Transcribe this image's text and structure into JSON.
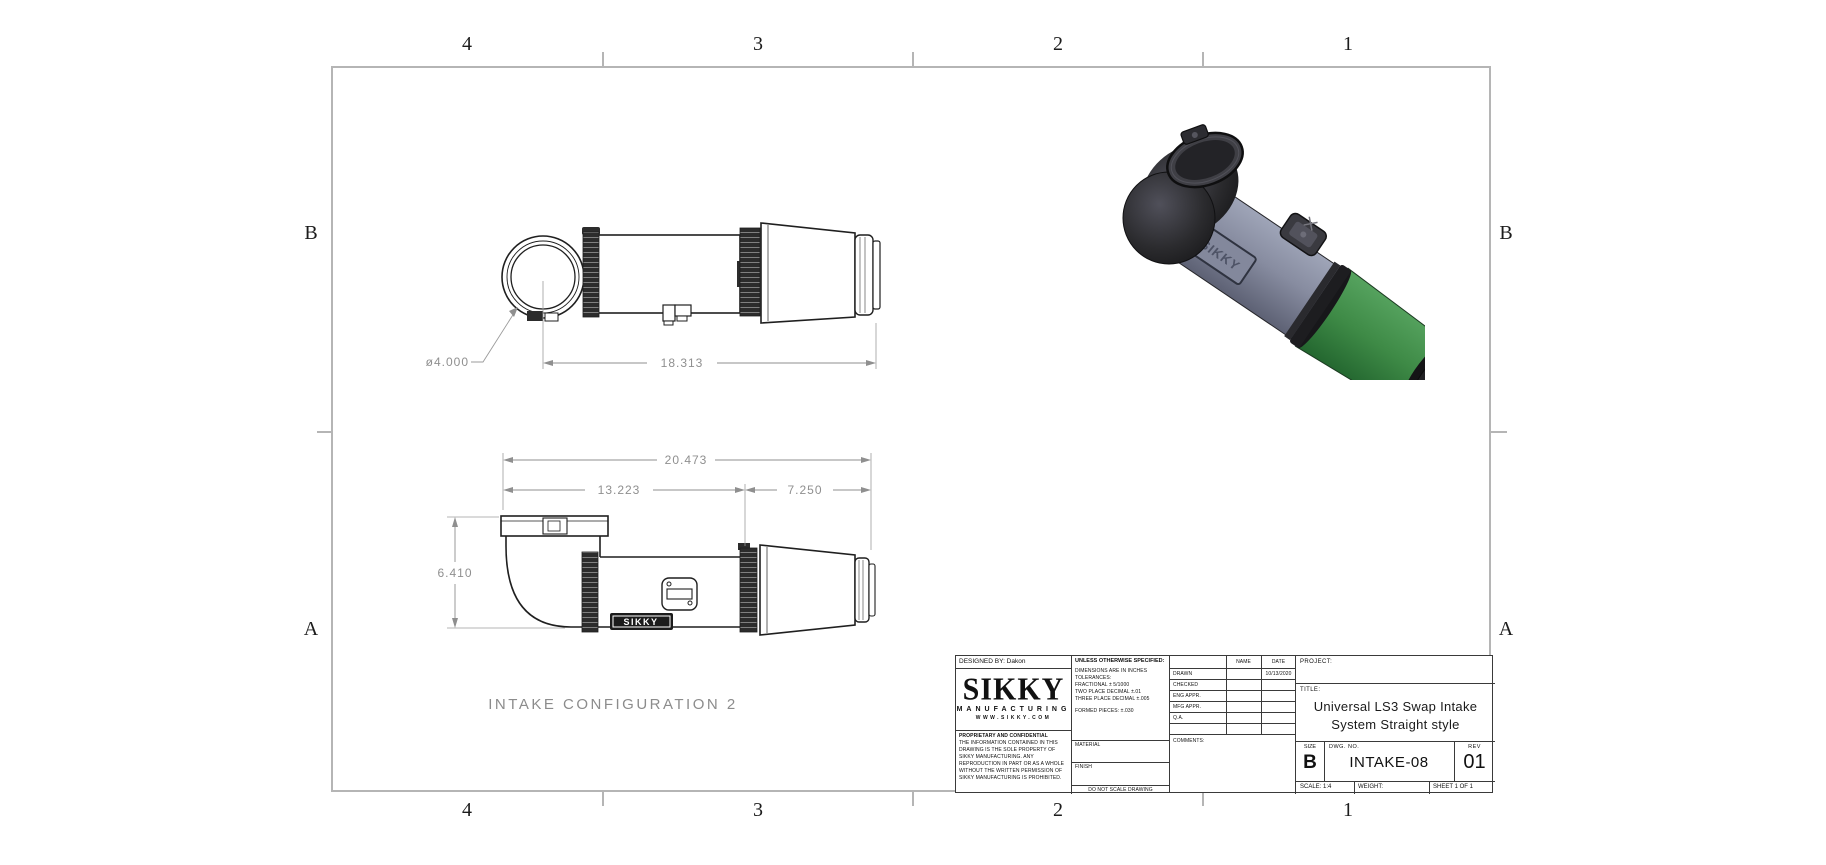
{
  "zones": {
    "top": [
      "4",
      "3",
      "2",
      "1"
    ],
    "bottom": [
      "4",
      "3",
      "2",
      "1"
    ],
    "left": [
      "B",
      "A"
    ],
    "right": [
      "B",
      "A"
    ]
  },
  "drawing": {
    "caption": "INTAKE CONFIGURATION 2",
    "badge": "SIKKY",
    "dims": {
      "diameter": "ø4.000",
      "overall_top": "18.313",
      "overall": "20.473",
      "tube": "13.223",
      "filter": "7.250",
      "height": "6.410"
    },
    "iso_colors": {
      "tube": "#878ca0",
      "filter": "#3e8a46",
      "elbow": "#2b2b2e",
      "cap": "#1a1a1d"
    }
  },
  "title_block": {
    "designed_by": "DESIGNED BY: Dakon",
    "logo": {
      "name": "SIKKY",
      "sub": "MANUFACTURING",
      "url": "WWW.SIKKY.COM"
    },
    "proprietary": {
      "heading": "PROPRIETARY AND CONFIDENTIAL",
      "body": "THE INFORMATION CONTAINED IN THIS DRAWING IS THE SOLE PROPERTY OF SIKKY MANUFACTURING.  ANY REPRODUCTION IN PART OR AS A WHOLE WITHOUT THE WRITTEN PERMISSION OF SIKKY MANUFACTURING IS PROHIBITED."
    },
    "spec": {
      "heading": "UNLESS OTHERWISE SPECIFIED:",
      "line1": "DIMENSIONS ARE IN INCHES",
      "line2": "TOLERANCES:",
      "line3": "FRACTIONAL ± 5/1000",
      "line4": "TWO PLACE DECIMAL    ±.01",
      "line5": "THREE PLACE DECIMAL  ±.005",
      "formed": "FORMED PIECES: ±.030"
    },
    "material_label": "MATERIAL",
    "finish_label": "FINISH",
    "no_scale": "DO NOT SCALE DRAWING",
    "approvals": {
      "name_header": "NAME",
      "date_header": "DATE",
      "rows": [
        {
          "label": "DRAWN",
          "date": "10/13/2020"
        },
        {
          "label": "CHECKED",
          "date": ""
        },
        {
          "label": "ENG APPR.",
          "date": ""
        },
        {
          "label": "MFG APPR.",
          "date": ""
        },
        {
          "label": "Q.A.",
          "date": ""
        }
      ],
      "comments_label": "COMMENTS:"
    },
    "project_label": "PROJECT:",
    "title_label": "TITLE:",
    "title_line1": "Universal LS3 Swap Intake",
    "title_line2": "System Straight style",
    "size_label": "SIZE",
    "size": "B",
    "dwg_label": "DWG.  NO.",
    "dwg_no": "INTAKE-08",
    "rev_label": "REV",
    "rev": "01",
    "scale": "SCALE: 1:4",
    "weight": "WEIGHT:",
    "sheet": "SHEET 1 OF 1"
  }
}
